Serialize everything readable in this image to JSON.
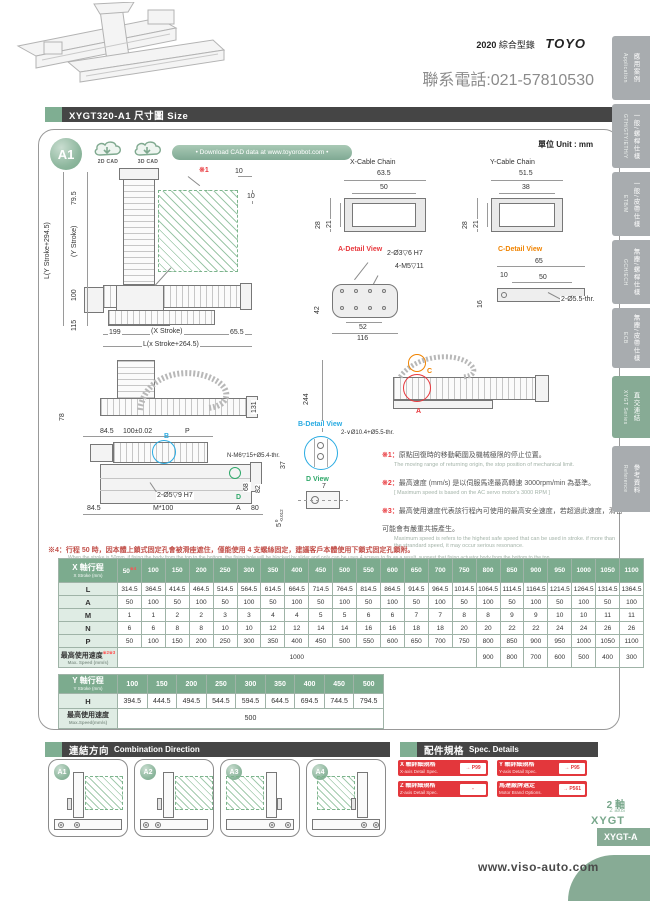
{
  "page": {
    "catalog_year": "2020",
    "catalog_label": "綜合型錄",
    "brand": "TOYO",
    "phone": "聯系電話:021-57810530",
    "website": "www.viso-auto.com",
    "unit_label": "單位 Unit : mm"
  },
  "sidebar": {
    "tabs": [
      {
        "zh": "應用案例",
        "en": "Application"
      },
      {
        "zh": "一般/螺桿仕樣",
        "en": "GTH/GTY/ETH/Y"
      },
      {
        "zh": "一般/皮帶仕樣",
        "en": "ETB/M"
      },
      {
        "zh": "無塵/螺桿仕樣",
        "en": "GCH/ECH"
      },
      {
        "zh": "無塵/皮帶仕樣",
        "en": "ECB"
      },
      {
        "zh": "直交連結",
        "en": "XYGT Series"
      },
      {
        "zh": "參考資料",
        "en": "Reference"
      }
    ]
  },
  "header": {
    "title": "XYGT320-A1 尺寸圖 Size"
  },
  "cad": {
    "badge": "A1",
    "btn_2d": "2D CAD",
    "btn_3d": "3D CAD",
    "pill": "• Download CAD data at www.toyorobot.com •"
  },
  "drawings": {
    "front": {
      "h_total": "L(Y Stroke+294.5)",
      "y_stroke": "(Y Stroke)",
      "d79": "79.5",
      "d100": "100",
      "d115": "115",
      "d199": "199",
      "x_stroke": "(X Stroke)",
      "d65": "65.5",
      "l_total": "L(x Stroke+264.5)",
      "ref": "※1",
      "d10a": "10",
      "d10b": "10"
    },
    "x_chain": {
      "title": "X-Cable Chain",
      "w_outer": "63.5",
      "w_inner": "50",
      "h_outer": "28",
      "h_inner": "21"
    },
    "y_chain": {
      "title": "Y-Cable Chain",
      "w_outer": "51.5",
      "w_inner": "38",
      "h_outer": "28",
      "h_inner": "21"
    },
    "a_detail": {
      "title": "A-Detail View",
      "callout1": "2-Ø3▽6 H7",
      "callout2": "4-M5▽11",
      "d42": "42",
      "d52": "52",
      "d116": "116"
    },
    "c_detail": {
      "title": "C-Detail View",
      "d65": "65",
      "d10": "10",
      "d50": "50",
      "d16": "16",
      "callout": "2-Ø5.5-thr."
    },
    "side_view": {
      "d78": "78",
      "d131": "131"
    },
    "plan_view": {
      "d84a": "84.5",
      "d100tol": "100±0.02",
      "p": "P",
      "b": "B",
      "callout_top": "N-M6▽15+Ø5.4-thr.",
      "d68": "68",
      "d82": "82",
      "callout_holes": "2-Ø5▽9 H7",
      "d_label": "D",
      "d84b": "84.5",
      "m100": "M*100",
      "a": "A",
      "d80": "80"
    },
    "x_plan": {
      "a": "A",
      "c": "C",
      "d244": "244"
    },
    "b_detail": {
      "title": "B-Detail View",
      "callout": "2-∨Ø10.4+Ø5.5-thr.",
      "d37": "37"
    },
    "d_view": {
      "title": "D View",
      "d7": "7",
      "tol_base": "5",
      "tol_up": "0",
      "tol_dn": "-0.012"
    }
  },
  "notes": {
    "n1": {
      "tag": "※1：",
      "zh": "原點回復時的移動範圍及機械極限的停止位置。",
      "en": "The moving range of returning origin, the stop position of mechanical limit."
    },
    "n2": {
      "tag": "※2：",
      "zh": "最高速度 (mm/s) 是以伺服馬達最高轉速 3000rpm/min 為基準。",
      "en": "[ Maximum speed is based on the AC servo motor's 3000 RPM ]"
    },
    "n3": {
      "tag": "※3：",
      "zh": "最高使用速度代表該行程內可使用的最高安全速度，若超過此速度，滑台可能會有嚴重共振產生。",
      "en": "Maximum speed is refers to the highest safe speed that can be used in stroke. if more than the strandard speed, it may occur serious resonance."
    },
    "ny": {
      "tag": "*",
      "zh": "Y 軸履帶活動端固定板由客戶自行連結。",
      "en": "Fixing plate for Y axis moving end of cable chain need to be assembled by customers."
    },
    "nx": {
      "tag": "*",
      "zh": "X 軸履帶固定端固定板由客戶自行連結。",
      "en": "Fixing plate for X axis moving end of cable chain need to be assembled by customers."
    },
    "n4": {
      "tag": "※4：",
      "zh": "行程 50 時，因本體上鎖式固定孔會被滑座遮住，僅能使用 4 支螺絲固定，建議客戶本體使用下鎖式固定孔鎖附。",
      "en": "When the stroke is 50mm, if fixing the body from the top to the bottom, the fixing hole will be blocked by slider and only can be uses 4 screws to fix,as a result, suggest that fixing actuator body from the bottom to the top."
    }
  },
  "x_table": {
    "header": {
      "zh": "X 軸行程",
      "en": "X Stroke (mm)"
    },
    "col0_sup": "※4",
    "columns": [
      "50",
      "100",
      "150",
      "200",
      "250",
      "300",
      "350",
      "400",
      "450",
      "500",
      "550",
      "600",
      "650",
      "700",
      "750",
      "800",
      "850",
      "900",
      "950",
      "1000",
      "1050",
      "1100"
    ],
    "rows": [
      {
        "label": "L",
        "values": [
          "314.5",
          "364.5",
          "414.5",
          "464.5",
          "514.5",
          "564.5",
          "614.5",
          "664.5",
          "714.5",
          "764.5",
          "814.5",
          "864.5",
          "914.5",
          "964.5",
          "1014.5",
          "1064.5",
          "1114.5",
          "1164.5",
          "1214.5",
          "1264.5",
          "1314.5",
          "1364.5"
        ]
      },
      {
        "label": "A",
        "values": [
          "50",
          "100",
          "50",
          "100",
          "50",
          "100",
          "50",
          "100",
          "50",
          "100",
          "50",
          "100",
          "50",
          "100",
          "50",
          "100",
          "50",
          "100",
          "50",
          "100",
          "50",
          "100"
        ]
      },
      {
        "label": "M",
        "values": [
          "1",
          "1",
          "2",
          "2",
          "3",
          "3",
          "4",
          "4",
          "5",
          "5",
          "6",
          "6",
          "7",
          "7",
          "8",
          "8",
          "9",
          "9",
          "10",
          "10",
          "11",
          "11"
        ]
      },
      {
        "label": "N",
        "values": [
          "6",
          "6",
          "8",
          "8",
          "10",
          "10",
          "12",
          "12",
          "14",
          "14",
          "16",
          "16",
          "18",
          "18",
          "20",
          "20",
          "22",
          "22",
          "24",
          "24",
          "26",
          "26"
        ]
      },
      {
        "label": "P",
        "values": [
          "50",
          "100",
          "150",
          "200",
          "250",
          "300",
          "350",
          "400",
          "450",
          "500",
          "550",
          "600",
          "650",
          "700",
          "750",
          "800",
          "850",
          "900",
          "950",
          "1000",
          "1050",
          "1100"
        ]
      }
    ],
    "speed_row": {
      "zh": "最高使用速度",
      "sup": "※2※3",
      "en": "Max. Speed (mm/s)",
      "cells": [
        {
          "value": "1000",
          "span": 15
        },
        {
          "value": "900",
          "span": 1
        },
        {
          "value": "800",
          "span": 1
        },
        {
          "value": "700",
          "span": 1
        },
        {
          "value": "600",
          "span": 1
        },
        {
          "value": "500",
          "span": 1
        },
        {
          "value": "400",
          "span": 1
        },
        {
          "value": "300",
          "span": 1
        }
      ]
    }
  },
  "y_table": {
    "header": {
      "zh": "Y 軸行程",
      "en": "Y Stroke (mm)"
    },
    "columns": [
      "100",
      "150",
      "200",
      "250",
      "300",
      "350",
      "400",
      "450",
      "500"
    ],
    "rows": [
      {
        "label": "H",
        "values": [
          "394.5",
          "444.5",
          "494.5",
          "544.5",
          "594.5",
          "644.5",
          "694.5",
          "744.5",
          "794.5"
        ]
      }
    ],
    "speed_row": {
      "zh": "最高使用速度",
      "en": "Max.Speed(mm/s)",
      "cells": [
        {
          "value": "500",
          "span": 9
        }
      ]
    }
  },
  "combination": {
    "title_zh": "連結方向",
    "title_en": "Combination Direction",
    "options": [
      "A1",
      "A2",
      "A3",
      "A4"
    ]
  },
  "spec_details": {
    "title_zh": "配件規格",
    "title_en": "Spec. Details",
    "items": [
      {
        "zh": "X 軸詳細規格",
        "en": "X-axis Detail Spec.",
        "page": "→ P99"
      },
      {
        "zh": "Y 軸詳細規格",
        "en": "Y-axis Detail Spec.",
        "page": "→ P95"
      },
      {
        "zh": "Z 軸詳細規格",
        "en": "Z-axis Detail Spec.",
        "page": "-"
      },
      {
        "zh": "馬達廠牌選定",
        "en": "Motor Brand Options.",
        "page": "→ P561"
      }
    ]
  },
  "footer": {
    "axis_zh": "2 軸",
    "axis_en": "2 axis",
    "series": "XYGT",
    "model_tab": "XYGT-A"
  }
}
